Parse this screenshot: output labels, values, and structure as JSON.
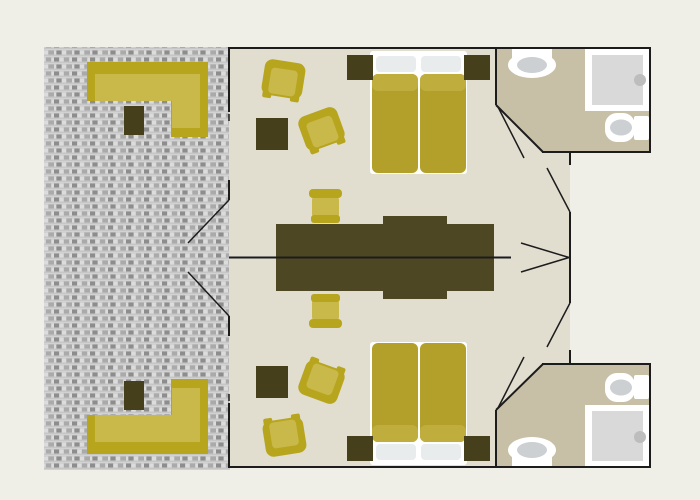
{
  "document": {
    "type": "floor-plan",
    "description": "Top-view floor plan of a twin-unit mobile home: shared wooden deck with two L-shaped benches on the left, two mirrored living/sleeping units in the middle (double bed, armchairs, dining chairs, long central table), and two en-suite bathrooms (washbasin, shower, toilet) on the right."
  },
  "colors": {
    "background": "#efeee7",
    "wall": "#1c1c1c",
    "floor": "#e1ddcf",
    "bathroom_floor": "#c7c0a7",
    "deck_base": "#c6c6c6",
    "deck_dark": "#8d8d8d",
    "deck_light": "#dcdcdc",
    "deck_mid": "#aaaaaa",
    "deck_row_line": "#d2d2d2",
    "furniture_dark": "#463f1b",
    "table_dark": "#4e4724",
    "sofa_dark": "#b7a51d",
    "sofa_light": "#c9b84a",
    "bed_mattress": "#b2a02b",
    "bed_sheet_band": "#bfae3e",
    "bed_base": "#ffffff",
    "pillow": "#e9eced",
    "fixture_white": "#ffffff",
    "fixture_gray": "#ccd0d2",
    "shower_tray": "#d9d9d9",
    "shower_knob": "#bdbdbd"
  },
  "areas": [
    {
      "name": "deck",
      "items": [
        "l-shaped-bench-top",
        "deck-table-top",
        "l-shaped-bench-bottom",
        "deck-table-bottom"
      ]
    },
    {
      "name": "living-unit-top",
      "items": [
        "armchair",
        "armchair",
        "side-table",
        "dining-chair",
        "double-bed",
        "two-pillows",
        "nightstand-left",
        "nightstand-right",
        "central-long-table"
      ]
    },
    {
      "name": "living-unit-bottom",
      "items": [
        "armchair",
        "armchair",
        "side-table",
        "dining-chair",
        "double-bed",
        "two-pillows",
        "nightstand-left",
        "nightstand-right",
        "central-long-table"
      ]
    },
    {
      "name": "bathroom-top",
      "items": [
        "washbasin",
        "shower",
        "toilet"
      ]
    },
    {
      "name": "bathroom-bottom",
      "items": [
        "washbasin",
        "shower",
        "toilet"
      ]
    }
  ]
}
